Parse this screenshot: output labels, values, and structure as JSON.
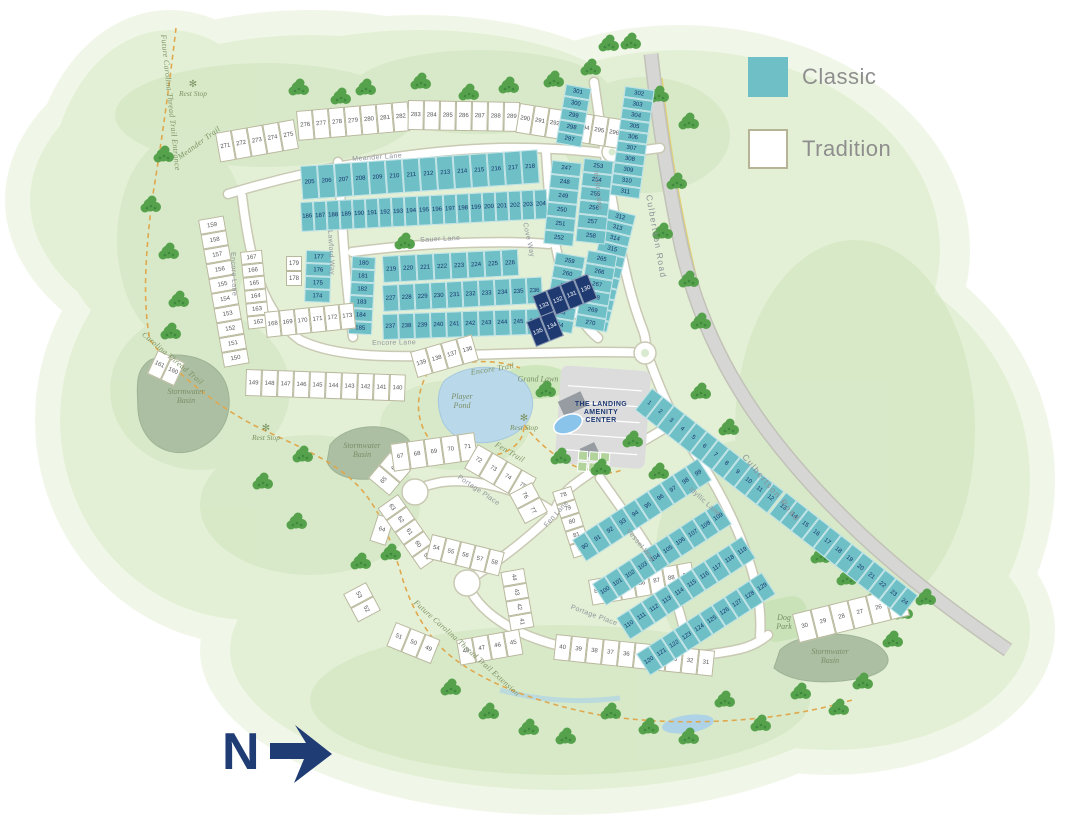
{
  "legend": {
    "items": [
      {
        "label": "Classic",
        "type": "classic",
        "color": "#6ebfc6"
      },
      {
        "label": "Tradition",
        "type": "tradition",
        "color": "#ffffff"
      }
    ]
  },
  "north": {
    "label": "N"
  },
  "amenity": {
    "name": "The Landing Amenity Center",
    "lines": [
      "THE LANDING",
      "AMENITY",
      "CENTER"
    ]
  },
  "colors": {
    "classic": "#6ebfc6",
    "tradition": "#ffffff",
    "highlight": "#1e3a70",
    "green": "#e4f0d6",
    "road": "#ffffff",
    "major_road": "#d6d6d4",
    "trail": "#e0a84e",
    "water": "#b9d8ea",
    "basin": "#adbfa3",
    "navy_text": "#1f3c74"
  },
  "map": {
    "street_labels": [
      {
        "text": "Meander Lane",
        "x": 352,
        "y": 156,
        "rot": -4
      },
      {
        "text": "Encore Lane",
        "x": 236,
        "y": 252,
        "rot": 88
      },
      {
        "text": "Encore Lane",
        "x": 372,
        "y": 340,
        "rot": -1
      },
      {
        "text": "Sauer Lane",
        "x": 420,
        "y": 237,
        "rot": -3
      },
      {
        "text": "Lawford Way",
        "x": 333,
        "y": 230,
        "rot": 87
      },
      {
        "text": "Cove Way",
        "x": 528,
        "y": 222,
        "rot": 78
      },
      {
        "text": "Idyllic Lane",
        "x": 599,
        "y": 170,
        "rot": 84
      },
      {
        "text": "Idyllic Lane",
        "x": 692,
        "y": 486,
        "rot": 42
      },
      {
        "text": "Culbertson Road",
        "x": 654,
        "y": 194,
        "rot": 80,
        "major": true
      },
      {
        "text": "Culbertson Road",
        "x": 748,
        "y": 452,
        "rot": 50,
        "major": true
      },
      {
        "text": "Fen Lane",
        "x": 543,
        "y": 524,
        "rot": -48
      },
      {
        "text": "Vessel Way",
        "x": 630,
        "y": 528,
        "rot": 50
      },
      {
        "text": "Portage Place",
        "x": 460,
        "y": 474,
        "rot": 34
      },
      {
        "text": "Portage Place",
        "x": 572,
        "y": 604,
        "rot": 20
      }
    ],
    "trail_labels": [
      {
        "text": "Future Carolina Thread Trail Entrance",
        "x": 168,
        "y": 34,
        "rot": 84
      },
      {
        "text": "Meander Trail",
        "x": 176,
        "y": 154,
        "rot": -36
      },
      {
        "text": "Carolina Thread Trail",
        "x": 146,
        "y": 330,
        "rot": 40
      },
      {
        "text": "Future Carolina Thread Trail Extension",
        "x": 418,
        "y": 598,
        "rot": 42
      },
      {
        "text": "Encore Trail",
        "x": 470,
        "y": 368,
        "rot": -9
      },
      {
        "text": "Fen Trail",
        "x": 498,
        "y": 440,
        "rot": 30
      }
    ],
    "area_labels": [
      {
        "text": "Stormwater\nBasin",
        "x": 186,
        "y": 396
      },
      {
        "text": "Stormwater\nBasin",
        "x": 362,
        "y": 450
      },
      {
        "text": "Stormwater\nBasin",
        "x": 830,
        "y": 656
      },
      {
        "text": "Dog\nPark",
        "x": 784,
        "y": 622
      },
      {
        "text": "Grand Lawn",
        "x": 538,
        "y": 379
      },
      {
        "text": "Player\nPond",
        "x": 462,
        "y": 401
      }
    ],
    "rest_stop_label": "Rest Stop",
    "rest_stops": [
      {
        "x": 193,
        "y": 80
      },
      {
        "x": 266,
        "y": 424
      },
      {
        "x": 524,
        "y": 414
      }
    ],
    "blocks": [
      {
        "id": "meander-row-1",
        "type": "tradition",
        "x": 215,
        "y": 133,
        "rot": -10,
        "w": 16,
        "h": 30,
        "lots": [
          271,
          272,
          273,
          274,
          275
        ]
      },
      {
        "id": "meander-row-2",
        "type": "tradition",
        "x": 296,
        "y": 111,
        "rot": -5,
        "w": 16,
        "h": 30,
        "lots": [
          276,
          277,
          278,
          279,
          280,
          281,
          282
        ]
      },
      {
        "id": "meander-row-3",
        "type": "tradition",
        "x": 408,
        "y": 100,
        "rot": 1,
        "w": 16,
        "h": 30,
        "lots": [
          283,
          284,
          285,
          286,
          287,
          288,
          289
        ]
      },
      {
        "id": "meander-row-4",
        "type": "tradition",
        "x": 520,
        "y": 103,
        "rot": 9,
        "w": 15,
        "h": 30,
        "lots": [
          290,
          291,
          292,
          293,
          294,
          295,
          296
        ]
      },
      {
        "id": "idyllic-col-west",
        "type": "classic",
        "v": true,
        "x": 566,
        "y": 84,
        "rot": 10,
        "w": 26,
        "h": 12,
        "lots": [
          301,
          300,
          299,
          298,
          297
        ]
      },
      {
        "id": "culbertson-col-1",
        "type": "classic",
        "v": true,
        "x": 625,
        "y": 86,
        "rot": 8,
        "w": 30,
        "h": 11,
        "lots": [
          302,
          303,
          304,
          305,
          306,
          307,
          308,
          309,
          310,
          311
        ]
      },
      {
        "id": "culbertson-col-2",
        "type": "classic",
        "v": true,
        "x": 607,
        "y": 208,
        "rot": 14,
        "w": 30,
        "h": 11,
        "lots": [
          312,
          313,
          314,
          315,
          316,
          317,
          318,
          319,
          320,
          321,
          322
        ]
      },
      {
        "id": "mid-upper-row-1",
        "type": "classic",
        "x": 300,
        "y": 166,
        "rot": -4,
        "w": 17,
        "h": 34,
        "lots": [
          205,
          206,
          207,
          208,
          209,
          210,
          211,
          212,
          213,
          214,
          215,
          216,
          217,
          218
        ]
      },
      {
        "id": "mid-upper-row-2",
        "type": "classic",
        "x": 300,
        "y": 202,
        "rot": -3,
        "w": 13,
        "h": 30,
        "lots": [
          186,
          187,
          188,
          189,
          190,
          191,
          192,
          193,
          194,
          195,
          196,
          197,
          198,
          199,
          200,
          201,
          202,
          203,
          204
        ]
      },
      {
        "id": "lawford-col",
        "type": "classic",
        "v": true,
        "x": 352,
        "y": 256,
        "rot": 3,
        "w": 24,
        "h": 13,
        "lots": [
          180,
          181,
          182,
          183,
          184,
          185
        ]
      },
      {
        "id": "mid-lower-row-1",
        "type": "classic",
        "x": 382,
        "y": 256,
        "rot": -3,
        "w": 17,
        "h": 27,
        "lots": [
          219,
          220,
          221,
          222,
          223,
          224,
          225,
          226
        ]
      },
      {
        "id": "mid-lower-row-2",
        "type": "classic",
        "x": 382,
        "y": 285,
        "rot": -3,
        "w": 16,
        "h": 27,
        "lots": [
          227,
          228,
          229,
          230,
          231,
          232,
          233,
          234,
          235,
          236
        ]
      },
      {
        "id": "mid-lower-row-3",
        "type": "classic",
        "x": 382,
        "y": 314,
        "rot": -2,
        "w": 16,
        "h": 26,
        "lots": [
          237,
          238,
          239,
          240,
          241,
          242,
          243,
          244,
          245,
          246
        ]
      },
      {
        "id": "cove-col-1",
        "type": "classic",
        "v": true,
        "x": 552,
        "y": 160,
        "rot": 6,
        "w": 30,
        "h": 14,
        "lots": [
          247,
          248,
          249,
          250,
          251,
          252
        ]
      },
      {
        "id": "cove-col-2",
        "type": "classic",
        "v": true,
        "x": 584,
        "y": 158,
        "rot": 6,
        "w": 30,
        "h": 14,
        "lots": [
          253,
          254,
          255,
          256,
          257,
          258
        ]
      },
      {
        "id": "cove-col-3",
        "type": "classic",
        "v": true,
        "x": 556,
        "y": 252,
        "rot": 10,
        "w": 30,
        "h": 13,
        "lots": [
          259,
          260,
          261,
          262,
          263,
          264
        ]
      },
      {
        "id": "cove-col-4",
        "type": "classic",
        "v": true,
        "x": 588,
        "y": 250,
        "rot": 10,
        "w": 30,
        "h": 13,
        "lots": [
          265,
          266,
          267,
          268,
          269,
          270
        ]
      },
      {
        "id": "featured-row-1",
        "type": "highlight",
        "x": 532,
        "y": 296,
        "rot": -22,
        "w": 15,
        "h": 27,
        "lots": [
          133,
          132,
          131,
          130
        ]
      },
      {
        "id": "featured-row-2",
        "type": "highlight",
        "x": 526,
        "y": 322,
        "rot": -22,
        "w": 15,
        "h": 27,
        "lots": [
          135,
          134
        ]
      },
      {
        "id": "encore-inner-col",
        "type": "tradition",
        "v": true,
        "x": 240,
        "y": 252,
        "rot": -6,
        "w": 22,
        "h": 13,
        "lots": [
          167,
          166,
          165,
          164,
          163,
          162
        ]
      },
      {
        "id": "encore-inner-pair",
        "type": "tradition",
        "v": true,
        "x": 286,
        "y": 256,
        "rot": 0,
        "w": 16,
        "h": 15,
        "lots": [
          179,
          178
        ]
      },
      {
        "id": "encore-inner-row",
        "type": "tradition",
        "x": 264,
        "y": 312,
        "rot": -6,
        "w": 15,
        "h": 26,
        "lots": [
          168,
          169,
          170,
          171,
          172,
          173
        ]
      },
      {
        "id": "encore-teal-col",
        "type": "classic",
        "v": true,
        "x": 306,
        "y": 250,
        "rot": 2,
        "w": 26,
        "h": 13,
        "lots": [
          177,
          176,
          175,
          174
        ]
      },
      {
        "id": "encore-outer-col",
        "type": "tradition",
        "v": true,
        "x": 198,
        "y": 220,
        "rot": -10,
        "w": 26,
        "h": 15,
        "lots": [
          159,
          158,
          157,
          156,
          155,
          154,
          153,
          152,
          151,
          150
        ]
      },
      {
        "id": "encore-outer-pair",
        "type": "tradition",
        "x": 158,
        "y": 350,
        "rot": 25,
        "w": 15,
        "h": 26,
        "lots": [
          161,
          160
        ]
      },
      {
        "id": "encore-south-row",
        "type": "tradition",
        "x": 246,
        "y": 369,
        "rot": 2,
        "w": 16,
        "h": 27,
        "lots": [
          149,
          148,
          147,
          146,
          145,
          144,
          143,
          142,
          141,
          140
        ]
      },
      {
        "id": "pond-row",
        "type": "tradition",
        "x": 410,
        "y": 352,
        "rot": -16,
        "w": 16,
        "h": 27,
        "lots": [
          139,
          138,
          137,
          136
        ]
      },
      {
        "id": "loop1-lot64",
        "type": "tradition",
        "x": 378,
        "y": 514,
        "rot": 18,
        "w": 17,
        "h": 28,
        "lots": [
          64
        ]
      },
      {
        "id": "loop1-west",
        "type": "tradition",
        "x": 368,
        "y": 478,
        "rot": -50,
        "w": 17,
        "h": 28,
        "lots": [
          65,
          66
        ]
      },
      {
        "id": "loop1-top",
        "type": "tradition",
        "x": 390,
        "y": 444,
        "rot": -8,
        "w": 17,
        "h": 28,
        "lots": [
          67,
          68,
          69,
          70,
          71
        ]
      },
      {
        "id": "loop1-east",
        "type": "tradition",
        "x": 478,
        "y": 444,
        "rot": 30,
        "w": 17,
        "h": 28,
        "lots": [
          72,
          73,
          74,
          75
        ]
      },
      {
        "id": "loop1-se",
        "type": "tradition",
        "x": 532,
        "y": 482,
        "rot": 62,
        "w": 17,
        "h": 26,
        "lots": [
          76,
          77
        ]
      },
      {
        "id": "loop1-inner",
        "type": "tradition",
        "x": 398,
        "y": 494,
        "rot": 55,
        "w": 15,
        "h": 25,
        "lots": [
          63,
          62,
          61,
          60,
          59
        ]
      },
      {
        "id": "mid-fan",
        "type": "tradition",
        "x": 432,
        "y": 534,
        "rot": 14,
        "w": 15,
        "h": 25,
        "lots": [
          54,
          55,
          56,
          57,
          58
        ]
      },
      {
        "id": "loop2-west",
        "type": "tradition",
        "x": 366,
        "y": 582,
        "rot": 62,
        "w": 16,
        "h": 26,
        "lots": [
          53,
          52
        ]
      },
      {
        "id": "loop2-south",
        "type": "tradition",
        "x": 396,
        "y": 622,
        "rot": 22,
        "w": 16,
        "h": 26,
        "lots": [
          51,
          50,
          49
        ]
      },
      {
        "id": "loop2-east",
        "type": "tradition",
        "x": 456,
        "y": 640,
        "rot": -10,
        "w": 16,
        "h": 26,
        "lots": [
          48,
          47,
          46,
          45
        ]
      },
      {
        "id": "loop2-col",
        "type": "tradition",
        "x": 524,
        "y": 568,
        "rot": 80,
        "w": 15,
        "h": 24,
        "lots": [
          44,
          43,
          42,
          41
        ]
      },
      {
        "id": "south-row",
        "type": "tradition",
        "x": 556,
        "y": 634,
        "rot": 6,
        "w": 16,
        "h": 26,
        "lots": [
          40,
          39,
          38,
          37,
          36,
          35,
          34,
          33,
          32,
          31
        ]
      },
      {
        "id": "southeast-row",
        "type": "tradition",
        "x": 792,
        "y": 614,
        "rot": -14,
        "w": 19,
        "h": 30,
        "lots": [
          30,
          29,
          28,
          27,
          26,
          25
        ]
      },
      {
        "id": "wedge-col",
        "type": "tradition",
        "v": true,
        "x": 552,
        "y": 492,
        "rot": -18,
        "w": 20,
        "h": 14,
        "lots": [
          78,
          79,
          80,
          81,
          82
        ]
      },
      {
        "id": "wedge-row",
        "type": "tradition",
        "x": 588,
        "y": 580,
        "rot": -10,
        "w": 15,
        "h": 26,
        "lots": [
          83,
          84,
          85,
          86,
          87,
          88,
          89
        ]
      },
      {
        "id": "fen-block-1",
        "type": "classic",
        "x": 572,
        "y": 540,
        "rot": -33,
        "w": 15,
        "h": 26,
        "lots": [
          90,
          91,
          92,
          93,
          94,
          95,
          96,
          97,
          98,
          99
        ]
      },
      {
        "id": "fen-block-2",
        "type": "classic",
        "x": 592,
        "y": 584,
        "rot": -33,
        "w": 15,
        "h": 26,
        "lots": [
          100,
          101,
          102,
          103,
          104,
          105,
          106,
          107,
          108,
          109
        ]
      },
      {
        "id": "fen-block-3",
        "type": "classic",
        "x": 616,
        "y": 618,
        "rot": -33,
        "w": 15,
        "h": 26,
        "lots": [
          110,
          111,
          112,
          113,
          114,
          115,
          116,
          117,
          118,
          119
        ]
      },
      {
        "id": "fen-block-4",
        "type": "classic",
        "x": 636,
        "y": 654,
        "rot": -33,
        "w": 15,
        "h": 26,
        "lots": [
          120,
          121,
          122,
          123,
          124,
          125,
          126,
          127,
          128,
          129
        ]
      },
      {
        "id": "culbertson-strip-1",
        "type": "classic",
        "x": 652,
        "y": 388,
        "rot": 38,
        "w": 14,
        "h": 28,
        "lots": [
          1,
          2,
          3,
          4,
          5,
          6,
          7,
          8,
          9,
          10,
          11,
          12
        ]
      },
      {
        "id": "culbertson-strip-2",
        "type": "classic",
        "x": 786,
        "y": 492,
        "rot": 38,
        "w": 14,
        "h": 28,
        "lots": [
          13,
          14,
          15,
          16,
          17,
          18,
          19,
          20,
          21,
          22,
          23,
          24
        ]
      }
    ]
  }
}
